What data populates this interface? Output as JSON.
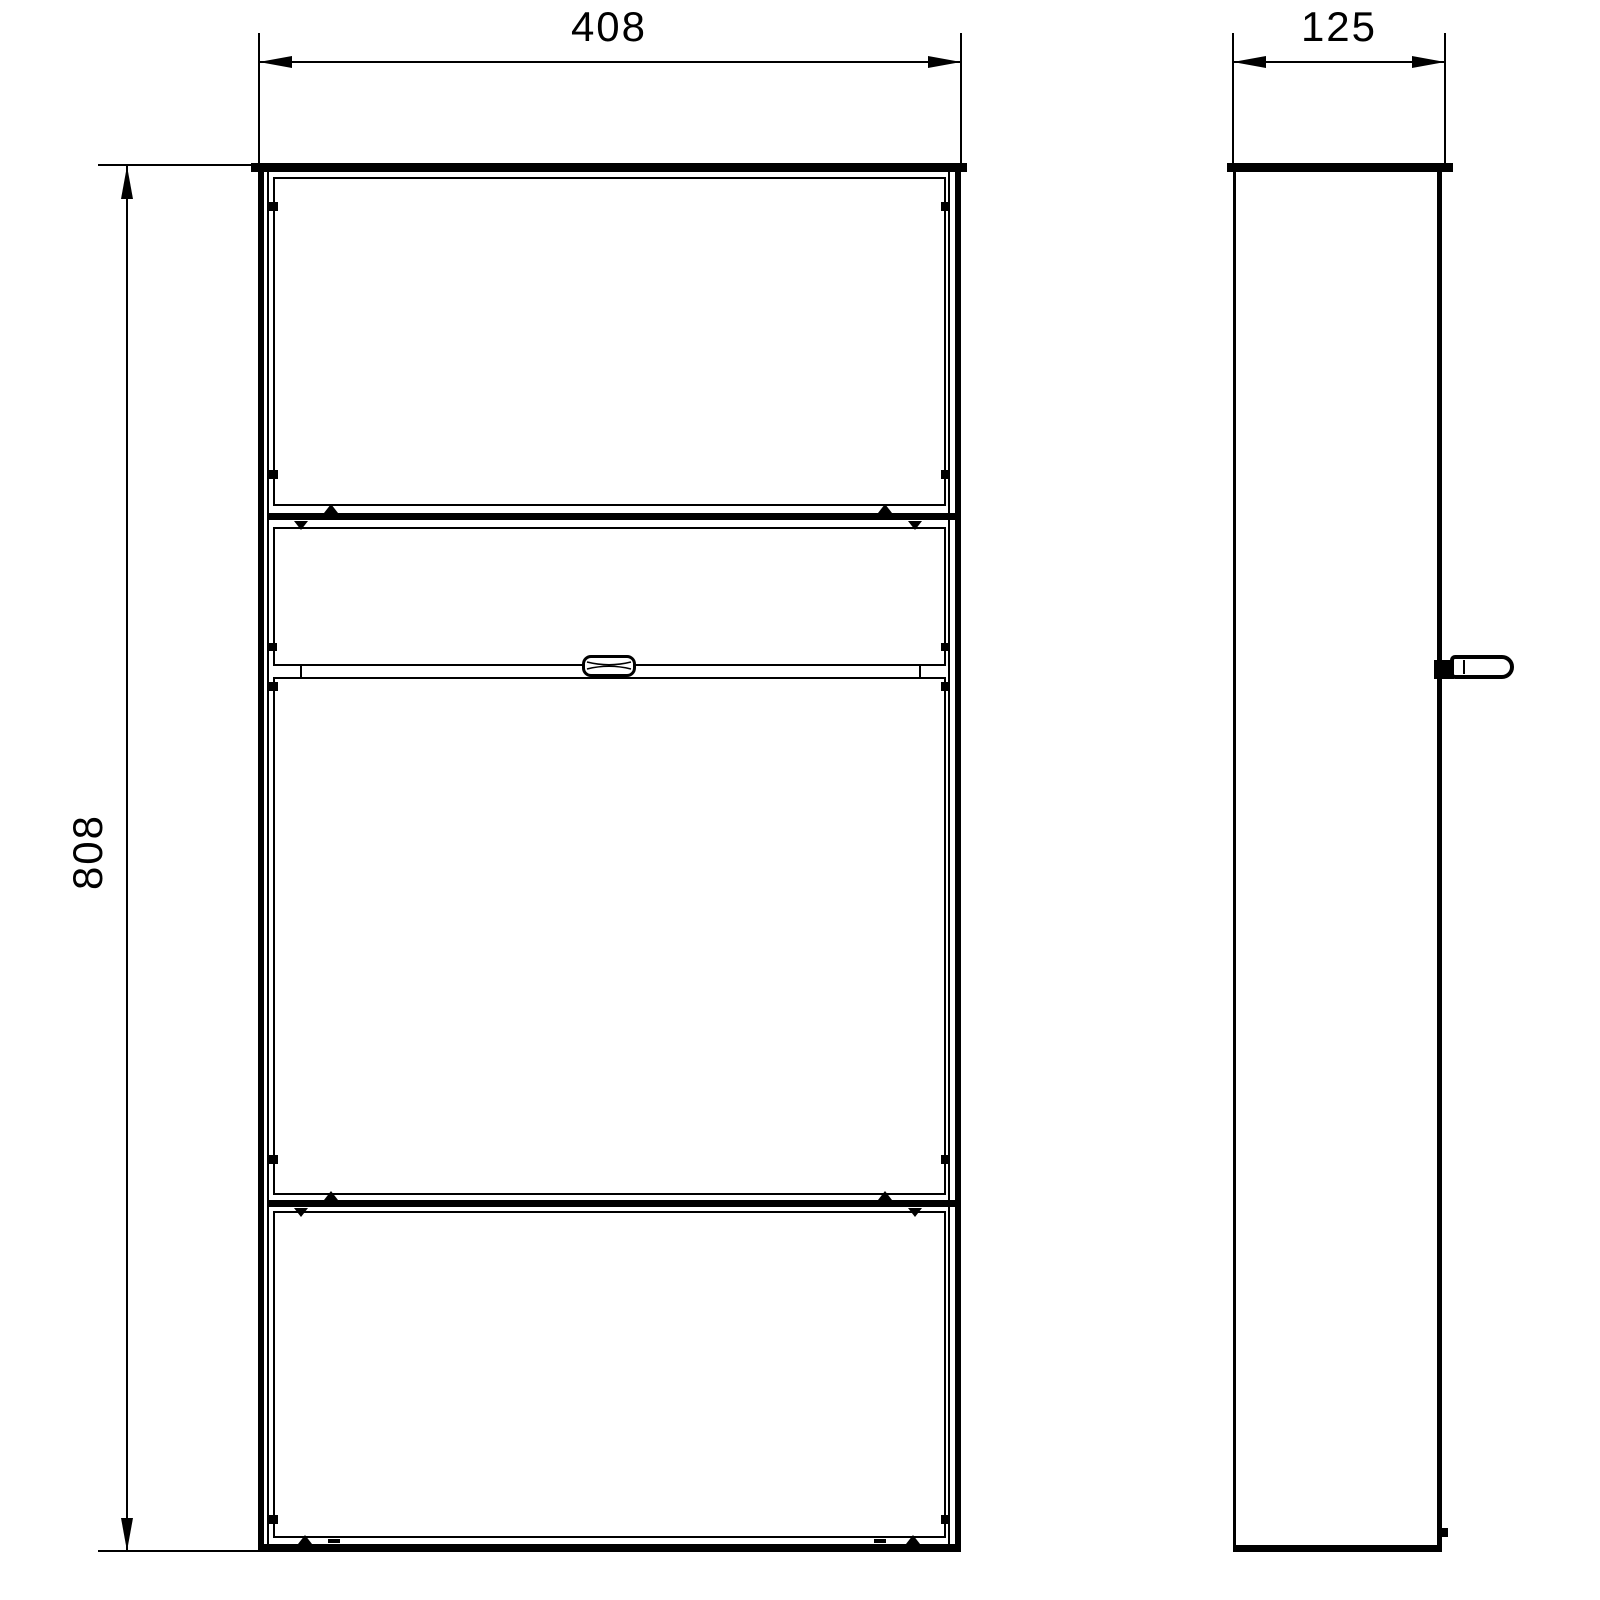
{
  "drawing": {
    "dimension_labels": {
      "width": "408",
      "height": "808",
      "depth": "125"
    },
    "colors": {
      "line": "#000000",
      "background": "#ffffff"
    }
  }
}
